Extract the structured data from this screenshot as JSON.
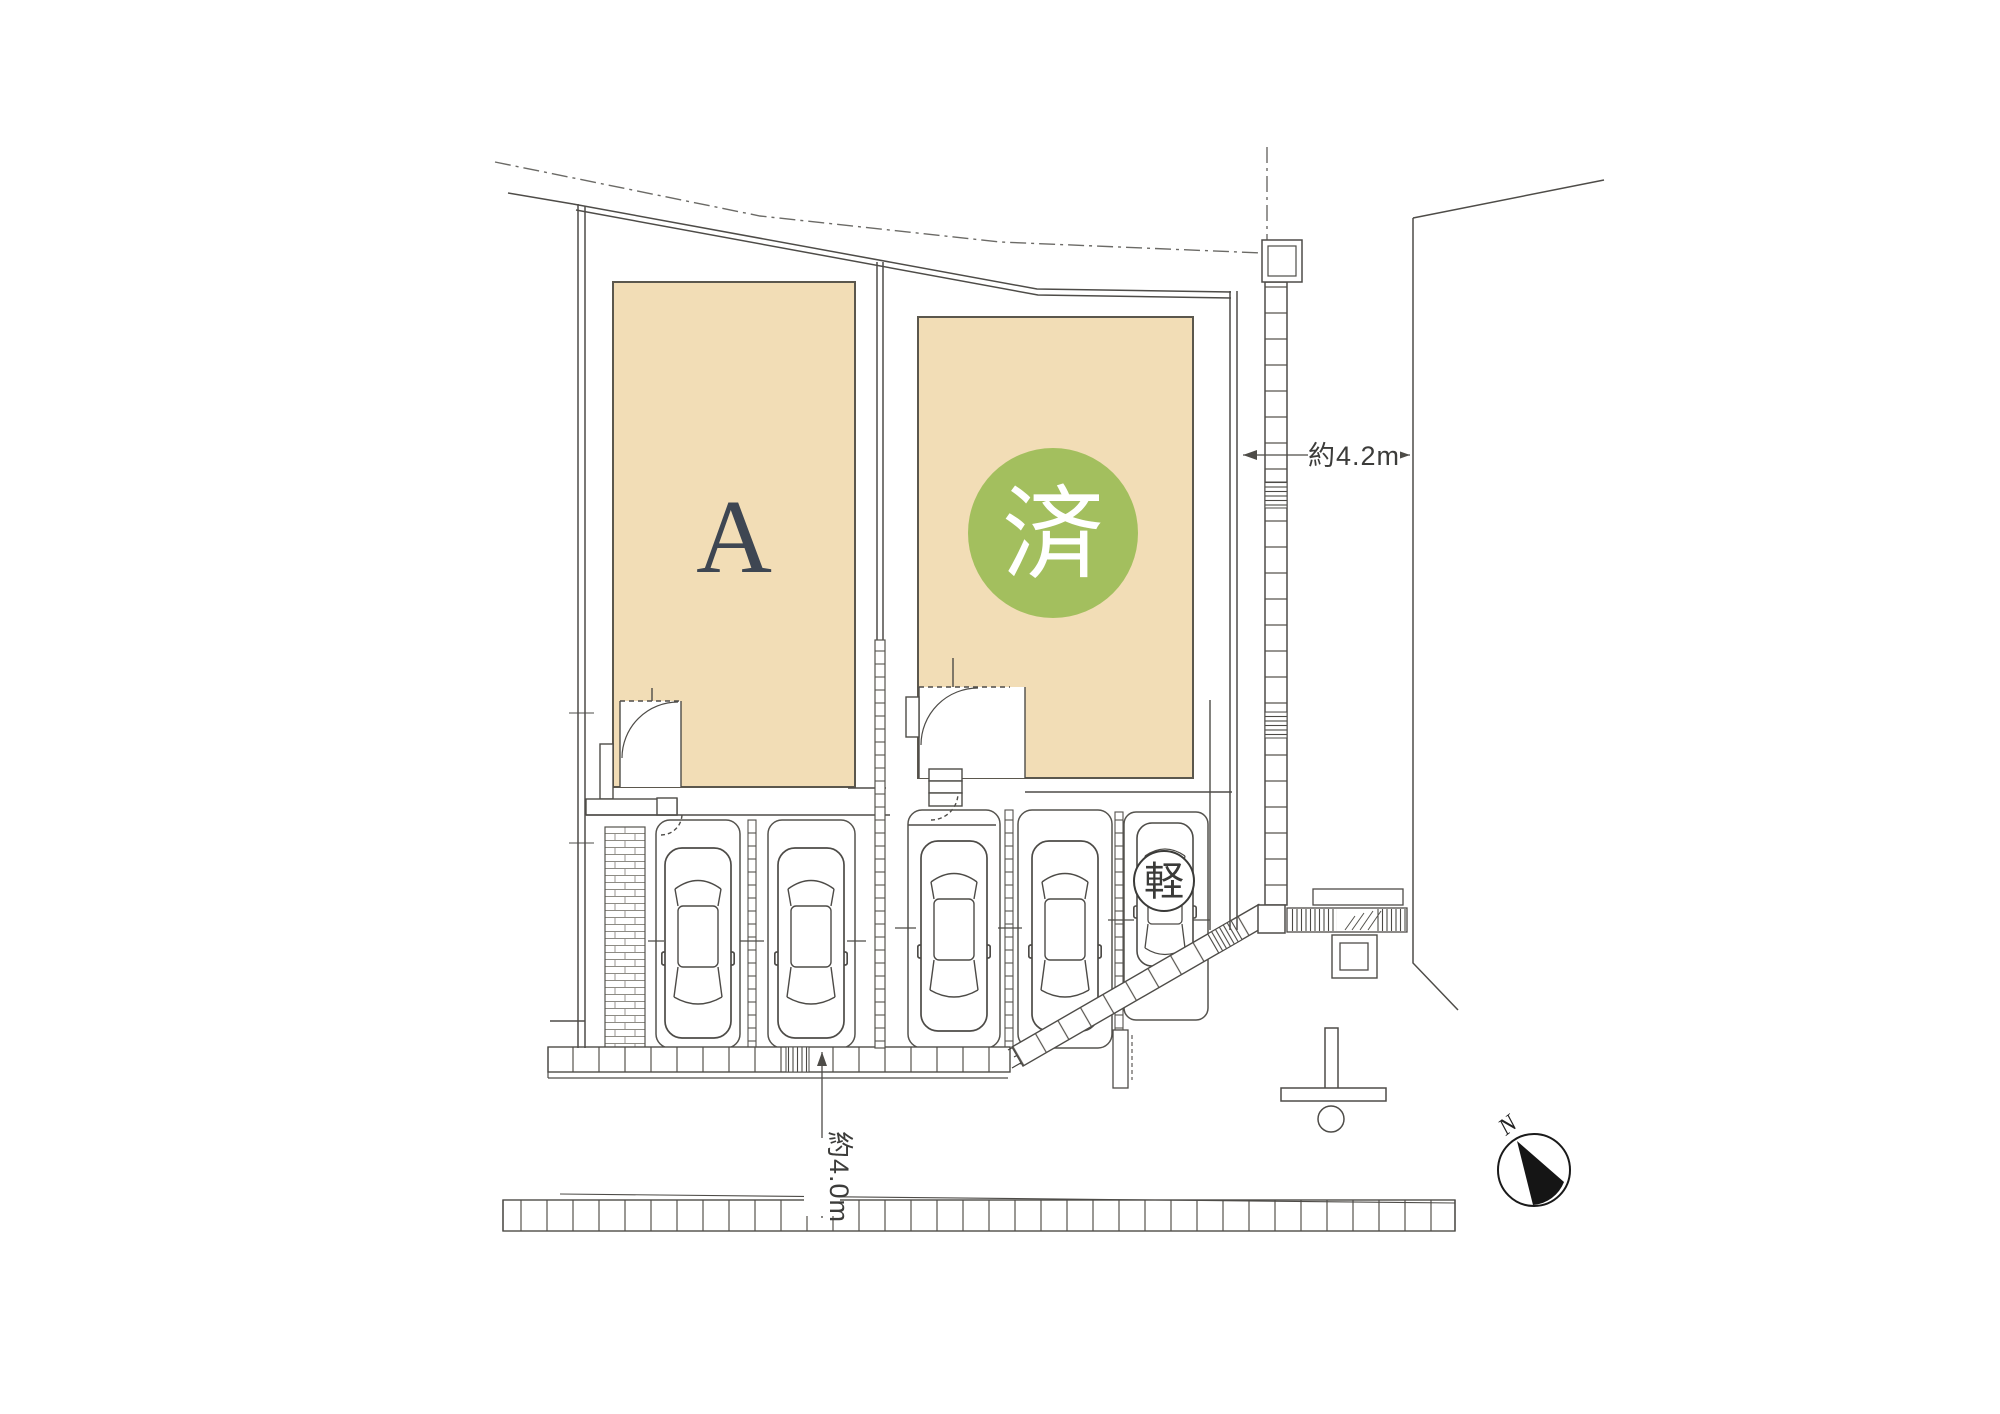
{
  "plan": {
    "title": "site-plan",
    "lot_a_label": "A",
    "sold_badge_label": "済",
    "kei_parking_label": "軽",
    "dimension_right_label": "約4.2m",
    "dimension_bottom_label": "約4.0m",
    "north_label": "N",
    "colors": {
      "building_fill": "#f2ddb6",
      "sold_circle_fill": "#a3bf5e",
      "lot_a_text": "#3e4652",
      "line": "#4e4c48"
    }
  }
}
